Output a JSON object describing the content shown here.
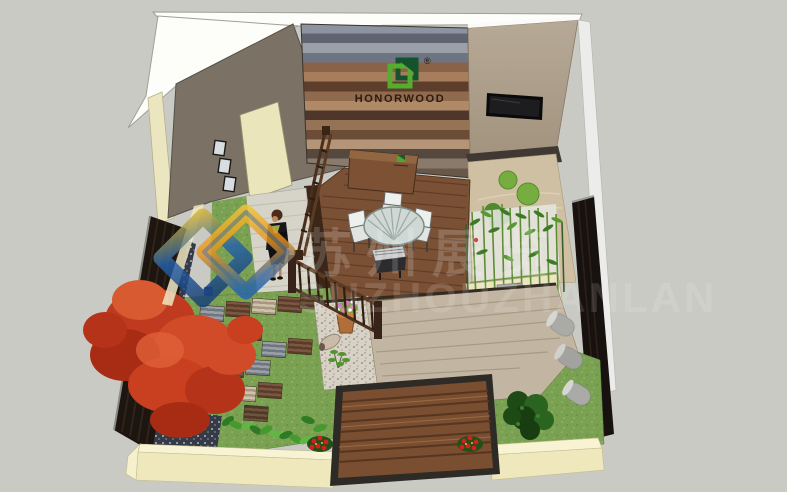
{
  "canvas": {
    "width": 787,
    "height": 492,
    "background_color": "#c9cac4"
  },
  "brand": {
    "name": "HONORWOOD",
    "registered_mark": "®",
    "logo_colors": {
      "dark_green": "#14532d",
      "light_green": "#54ad2c"
    },
    "wordmark_color": "#2b1c0e"
  },
  "watermark": {
    "cjk_text": "苏州展览",
    "latin_text": "SUZHOUZHANLAN",
    "logo_colors": {
      "yellow": "#f2c01e",
      "blue": "#2563ae",
      "orange": "#e8921c"
    }
  },
  "scene": {
    "type": "3d-garden-design-render",
    "objects": [
      "striped-wpc-feature-wall",
      "honorwood-logo-sign",
      "left-house-wall",
      "door",
      "picture-frames",
      "beige-wall",
      "wall-tv",
      "zen-gravel-garden",
      "moss-mounds",
      "bamboo-grove",
      "planter-box",
      "stone-cushions",
      "wood-deck",
      "round-glass-table",
      "white-chairs",
      "bbq-grill",
      "deck-railing",
      "standing-woman",
      "light-wood-path",
      "lawn",
      "paving-tile-path",
      "red-maple-tree",
      "pebble-bed",
      "gravel-bed-with-pots",
      "wooden-step-platform",
      "tan-deck",
      "hosta-border",
      "red-flower-shrubs",
      "evergreen-shrub",
      "cream-perimeter-wall",
      "dark-wood-fence-left",
      "dark-wood-fence-right",
      "stone-rollers"
    ],
    "materials": {
      "deck_brown": "#7b5136",
      "deck_tan": "#c2b5a2",
      "grass_green": "#7aa152",
      "cream_wall": "#efe8bd",
      "taupe_wall": "#7b7265",
      "beige_wall": "#b3a693",
      "fence_dark": "#1c1510",
      "maple_red": "#c23a22"
    }
  }
}
